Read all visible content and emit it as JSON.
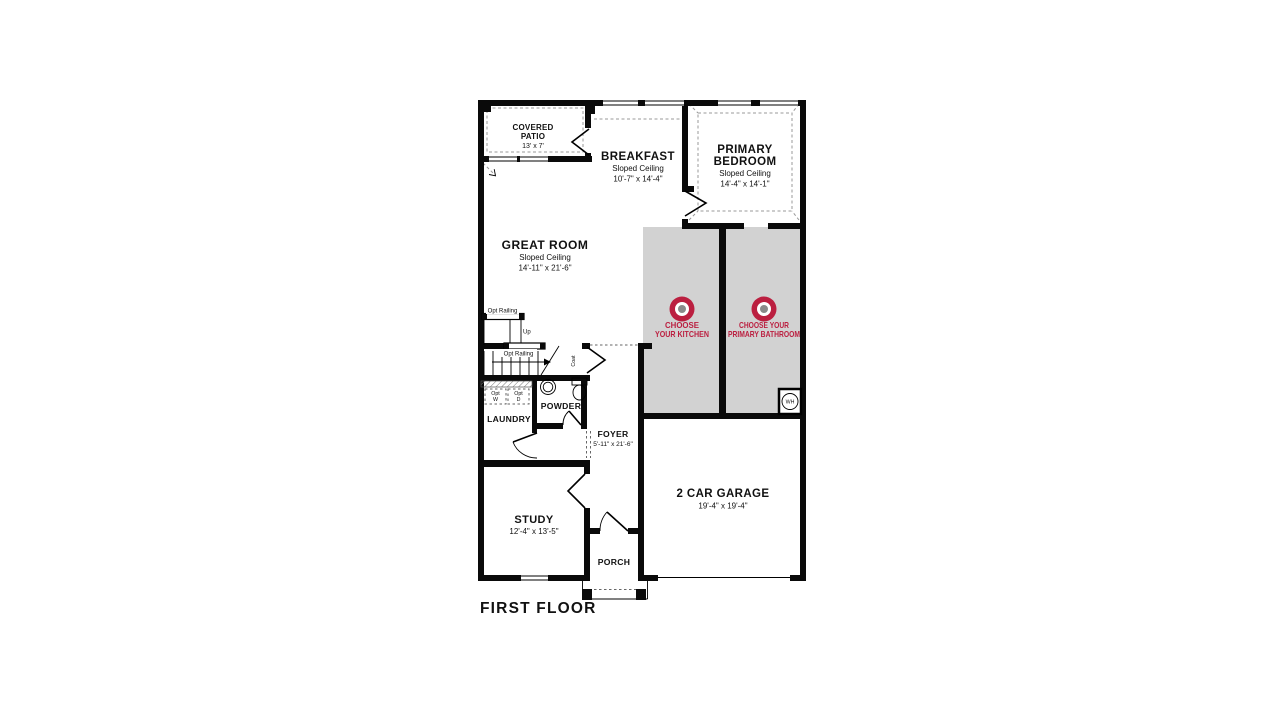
{
  "plan": {
    "title": "FIRST FLOOR",
    "rooms": {
      "covered_patio": {
        "line1": "COVERED",
        "line2": "PATIO",
        "dims": "13' x 7'"
      },
      "breakfast": {
        "name": "BREAKFAST",
        "ceiling": "Sloped Ceiling",
        "dims": "10'-7\" x 14'-4\""
      },
      "primary_bedroom": {
        "line1": "PRIMARY",
        "line2": "BEDROOM",
        "ceiling": "Sloped Ceiling",
        "dims": "14'-4\" x 14'-1\""
      },
      "great_room": {
        "name": "GREAT ROOM",
        "ceiling": "Sloped Ceiling",
        "dims": "14'-11\" x 21'-6\""
      },
      "laundry": {
        "name": "LAUNDRY"
      },
      "powder": {
        "name": "POWDER"
      },
      "foyer": {
        "name": "FOYER",
        "dims": "5'-11\" x 21'-6\""
      },
      "study": {
        "name": "STUDY",
        "dims": "12'-4\" x 13'-5\""
      },
      "porch": {
        "name": "PORCH"
      },
      "garage": {
        "name": "2 CAR GARAGE",
        "dims": "19'-4\" x 19'-4\""
      }
    },
    "hotspots": {
      "kitchen": {
        "line1": "CHOOSE",
        "line2": "YOUR KITCHEN"
      },
      "primary_bathroom": {
        "line1": "CHOOSE YOUR",
        "line2": "PRIMARY BATHROOM"
      }
    },
    "annotations": {
      "opt_railing_upper": "Opt Railing",
      "opt_railing_lower": "Opt Railing",
      "up": "Up",
      "coat": "Coat",
      "water_heater": "WH",
      "opt_washer": {
        "line1": "Opt",
        "line2": "W"
      },
      "opt_dryer": {
        "line1": "Opt",
        "line2": "D"
      }
    },
    "colors": {
      "accent_red": "#bb1f40",
      "area_gray": "#d2d2d2",
      "wall_black": "#0a0a0a",
      "marker_gray": "#8a8a8a"
    }
  }
}
